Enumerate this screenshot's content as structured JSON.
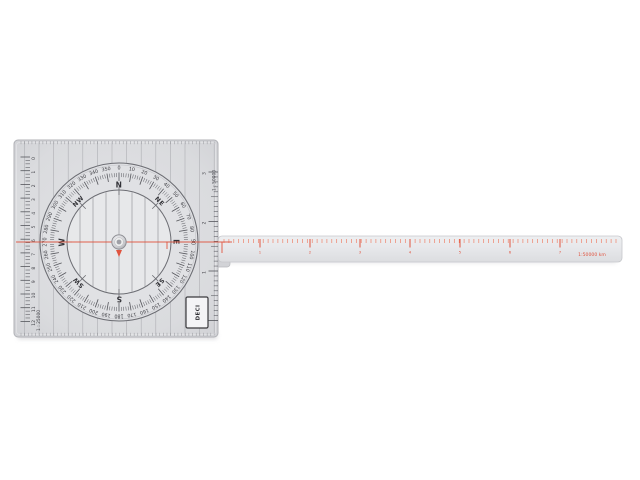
{
  "scene": {
    "background": "#ffffff",
    "object": "course-plotter"
  },
  "plotter": {
    "colors": {
      "plate_fill": "#dadbde",
      "plate_edge": "#b0b1b6",
      "arm_fill": "#e7e8eb",
      "arm_edge": "#c6c7cb",
      "ring_fill": "#e0e1e4",
      "disc_fill": "#e7e8ea",
      "circle_line": "#6c6d73",
      "grid_line": "#a6a7ac",
      "tick_dark": "#55565c",
      "text_dark": "#3c3c42",
      "red": "#e0543f",
      "red_soft": "#ee7a60",
      "metal": "#d8d9dc",
      "shadow": "#b5b6bc"
    },
    "dial": {
      "degree_labels": [
        "0",
        "10",
        "20",
        "30",
        "40",
        "50",
        "60",
        "70",
        "80",
        "90",
        "100",
        "110",
        "120",
        "130",
        "140",
        "150",
        "160",
        "170",
        "180",
        "190",
        "200",
        "210",
        "220",
        "230",
        "240",
        "250",
        "260",
        "270",
        "280",
        "290",
        "300",
        "310",
        "320",
        "330",
        "340",
        "350"
      ],
      "cardinals": [
        {
          "label": "N",
          "deg": 0
        },
        {
          "label": "NE",
          "deg": 45
        },
        {
          "label": "E",
          "deg": 90
        },
        {
          "label": "SE",
          "deg": 135
        },
        {
          "label": "S",
          "deg": 180
        },
        {
          "label": "SW",
          "deg": 225
        },
        {
          "label": "W",
          "deg": 270
        },
        {
          "label": "NW",
          "deg": 315
        }
      ]
    },
    "left_scale": {
      "label": "1 : 25000",
      "numbers": [
        "0",
        "1",
        "2",
        "3",
        "4",
        "5",
        "6",
        "7",
        "8",
        "9",
        "10",
        "11",
        "12"
      ]
    },
    "right_scale": {
      "label": "1 : 50000",
      "numbers": [
        "0",
        "1",
        "2",
        "3"
      ]
    },
    "arm_scale": {
      "label": "1:50000 km",
      "numbers": [
        "1",
        "2",
        "3",
        "4",
        "5",
        "6",
        "7"
      ]
    },
    "brand_label": "DECI"
  }
}
